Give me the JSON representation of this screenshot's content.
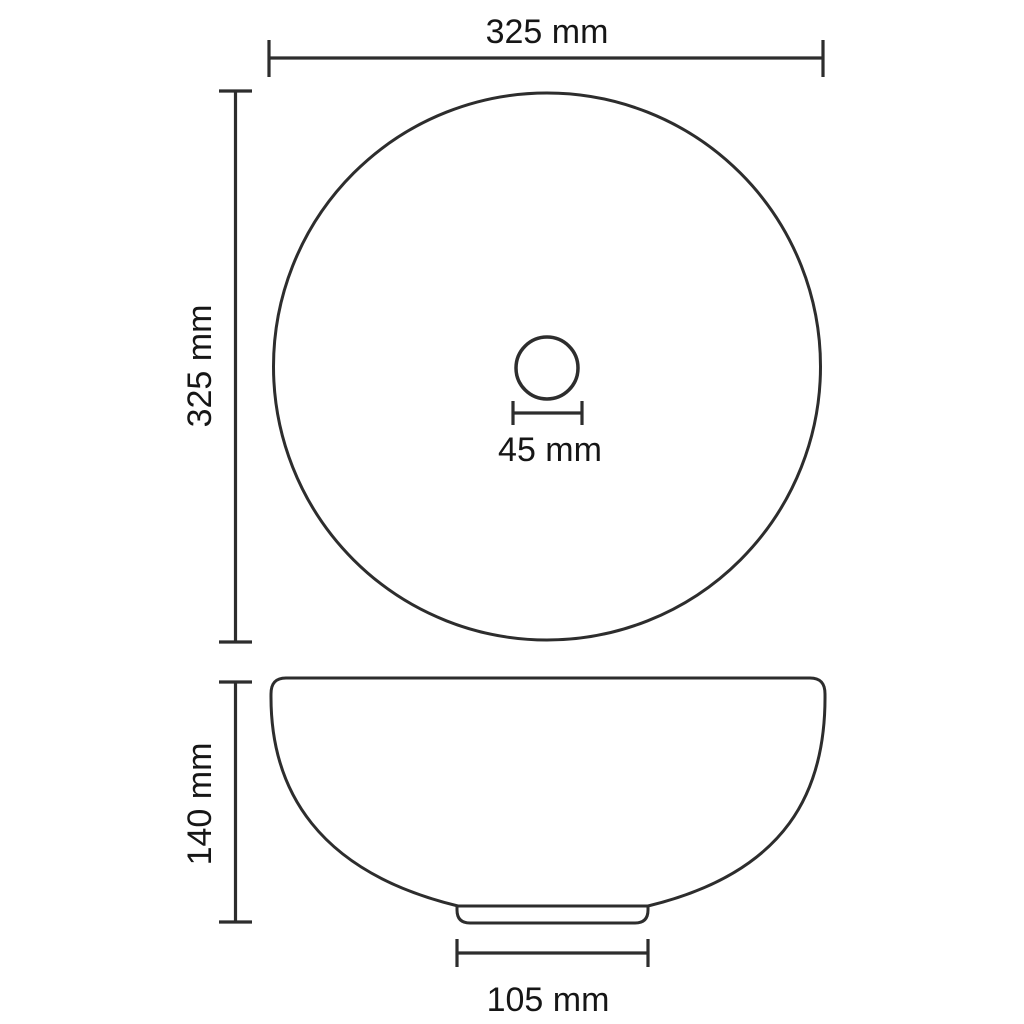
{
  "drawing": {
    "unit": "mm",
    "colors": {
      "background": "#ffffff",
      "line": "#2d2d2d",
      "text": "#161616"
    },
    "dimensions": {
      "overall_width": {
        "label": "325 mm",
        "value": 325,
        "unit": "mm",
        "orientation": "horizontal"
      },
      "overall_depth": {
        "label": "325 mm",
        "value": 325,
        "unit": "mm",
        "orientation": "vertical"
      },
      "drain_diameter": {
        "label": "45 mm",
        "value": 45,
        "unit": "mm",
        "orientation": "horizontal"
      },
      "overall_height": {
        "label": "140 mm",
        "value": 140,
        "unit": "mm",
        "orientation": "vertical"
      },
      "base_diameter": {
        "label": "105 mm",
        "value": 105,
        "unit": "mm",
        "orientation": "horizontal"
      }
    }
  }
}
